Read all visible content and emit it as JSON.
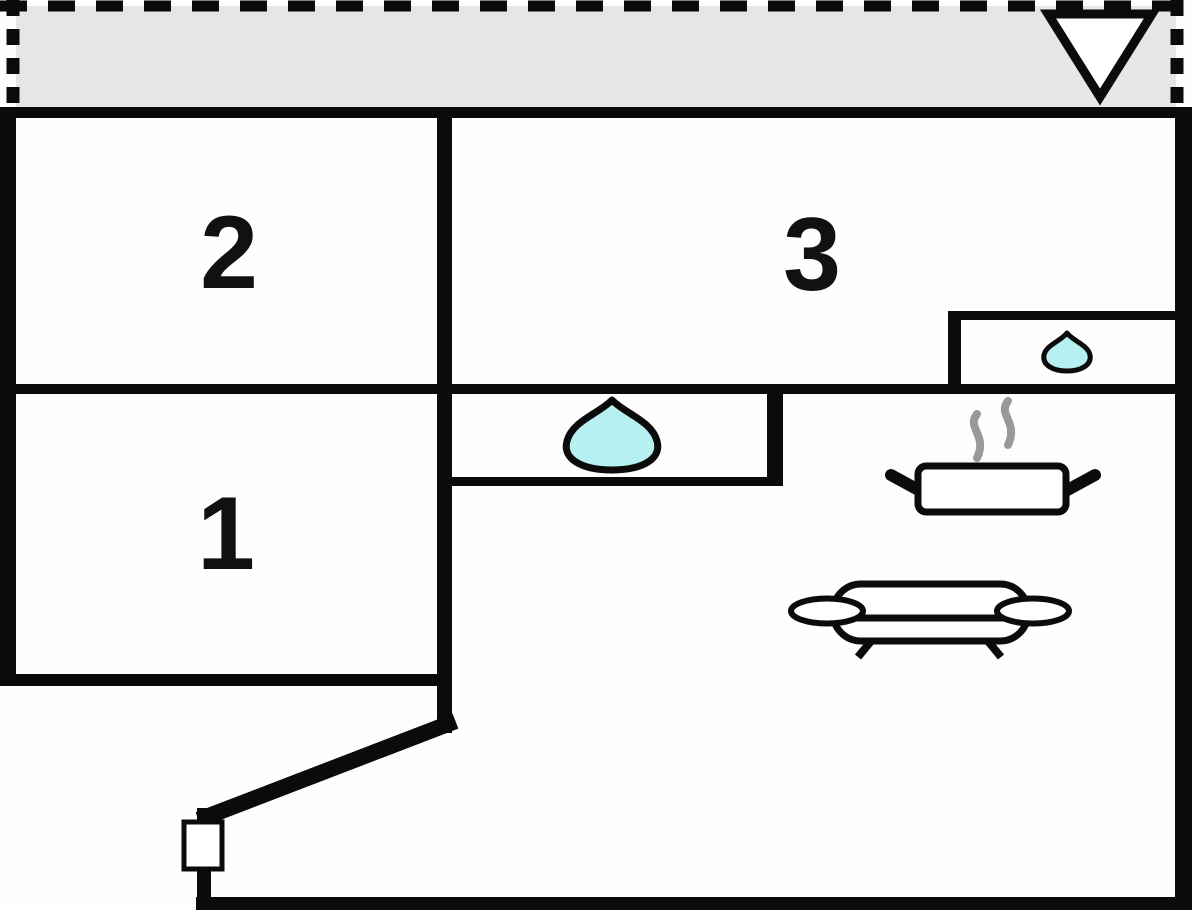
{
  "plan": {
    "kind": "apartment-floor-plan",
    "rooms": [
      {
        "name": "room-1",
        "number": "1"
      },
      {
        "name": "room-2",
        "number": "2"
      },
      {
        "name": "room-3",
        "number": "3"
      }
    ],
    "symbols": {
      "entrance_arrow": "down-triangle-icon",
      "bath_water": "water-drop-icon",
      "sink_water": "water-drop-icon",
      "stove": "steaming-pot-icon",
      "sofa": "sofa-icon",
      "door": "door-marker"
    },
    "colors": {
      "wall": "#0b0b0b",
      "terrace_fill": "#e6e6e6",
      "water_fill": "#b6f0f1",
      "steam": "#999999",
      "background": "#fefefe",
      "room_fill": "#ffffff"
    }
  }
}
